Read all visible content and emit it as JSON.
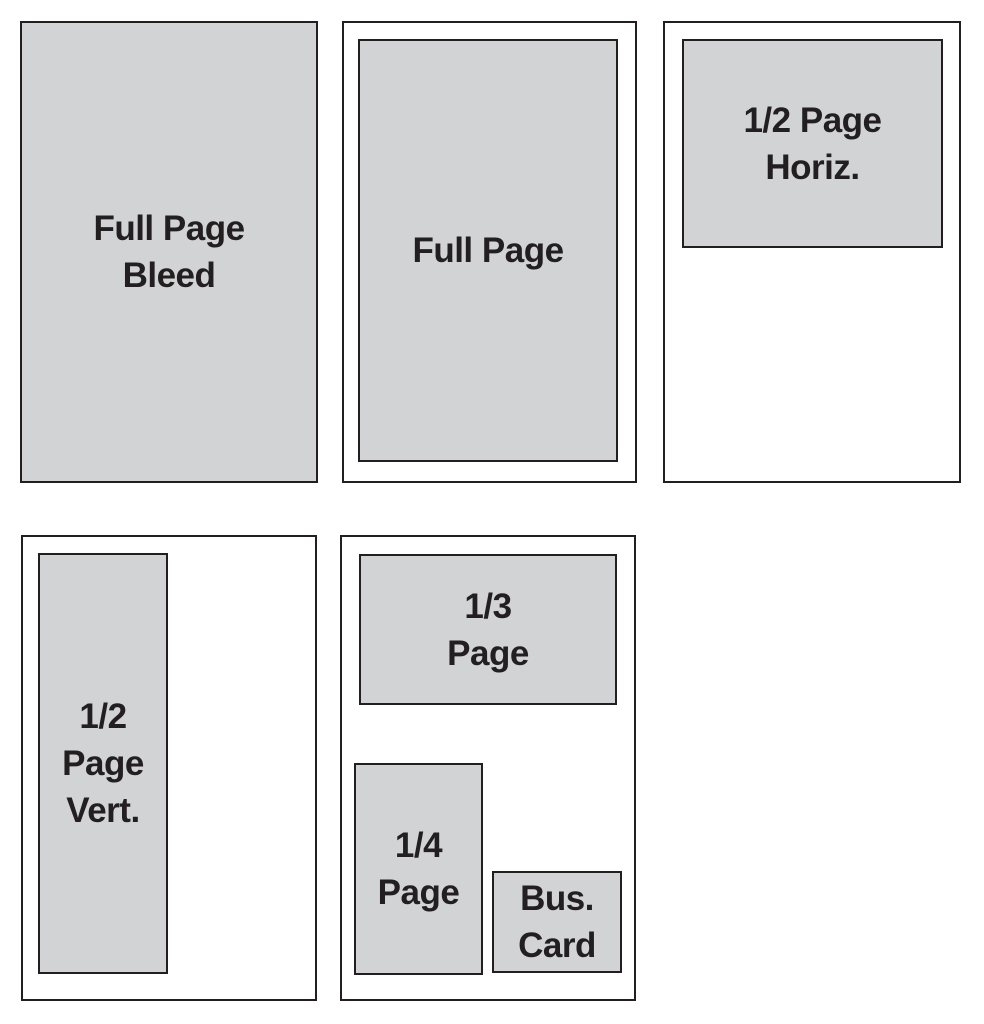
{
  "colors": {
    "background": "#ffffff",
    "outline": "#231f20",
    "box_fill": "#d1d3d4",
    "text": "#231f20"
  },
  "panels": [
    {
      "name": "full-page-bleed",
      "label": "Full Page\nBleed"
    },
    {
      "name": "full-page",
      "label": "Full Page"
    },
    {
      "name": "half-page-horizontal",
      "label": "1/2 Page\nHoriz."
    },
    {
      "name": "half-page-vertical",
      "label": "1/2\nPage\nVert."
    },
    {
      "name": "third-quarter-buscard",
      "boxes": [
        {
          "name": "third-page",
          "label": "1/3\nPage"
        },
        {
          "name": "quarter-page",
          "label": "1/4\nPage"
        },
        {
          "name": "business-card",
          "label": "Bus.\nCard"
        }
      ]
    }
  ]
}
